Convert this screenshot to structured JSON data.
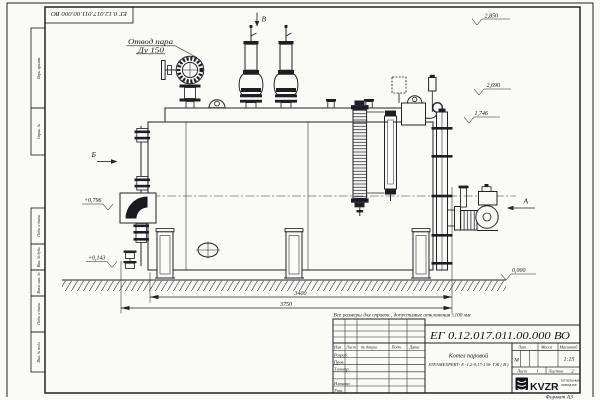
{
  "frame": {
    "top_designation": "ЕГ 0.12.017.011.00.000  ВО",
    "format_label": "Формат А3",
    "margin_boxes": [
      {
        "label": "Перв. примен."
      },
      {
        "label": "Справ. №"
      },
      {
        "label": "Подп. и дата"
      },
      {
        "label": "Инв. № дубл."
      },
      {
        "label": "Взам. инв. №"
      },
      {
        "label": "Подп. и дата"
      },
      {
        "label": "Инв. № подл."
      }
    ]
  },
  "drawing": {
    "steam_outlet_label_line1": "Отвод пара",
    "steam_outlet_label_line2": "Ду 150",
    "view_top": "В",
    "view_left": "Б",
    "view_right": "А",
    "elevations": {
      "top": "2,850",
      "upper": "2,690",
      "mid": "1,746",
      "burner": "+0,796",
      "low": "+0,143",
      "ground": "0,000"
    },
    "dimensions": {
      "inner_length": "3400",
      "overall_length": "3750"
    }
  },
  "note": "Все размеры для справок , допустимые отклонения ±100 мм",
  "title_block": {
    "designation": "ЕГ 0.12.017.011.00.000  ВО",
    "product_name_line1": "Котел паровой",
    "product_name_line2": "STEAMEXPERT- Е -1,2-0,17-130- ГЖ ( В )",
    "columns": [
      "Изм.",
      "Лист",
      "№ докум.",
      "Подп.",
      "Дата"
    ],
    "rows": [
      "Разраб.",
      "Пров.",
      "Т.контр.",
      "Н.контр.",
      "Утв."
    ],
    "lit_label": "Лит.",
    "lit_value": "М",
    "mass_label": "Масса",
    "scale_label": "Масштаб",
    "scale_value": "1:15",
    "sheet_label": "Лист",
    "sheet_value": "1",
    "sheets_label": "Листов",
    "sheets_value": "2",
    "company_logo": "KVZR",
    "company_line1": "КОТЕЛЬНЫЙ",
    "company_line2": "ЗАВОД РФ"
  }
}
